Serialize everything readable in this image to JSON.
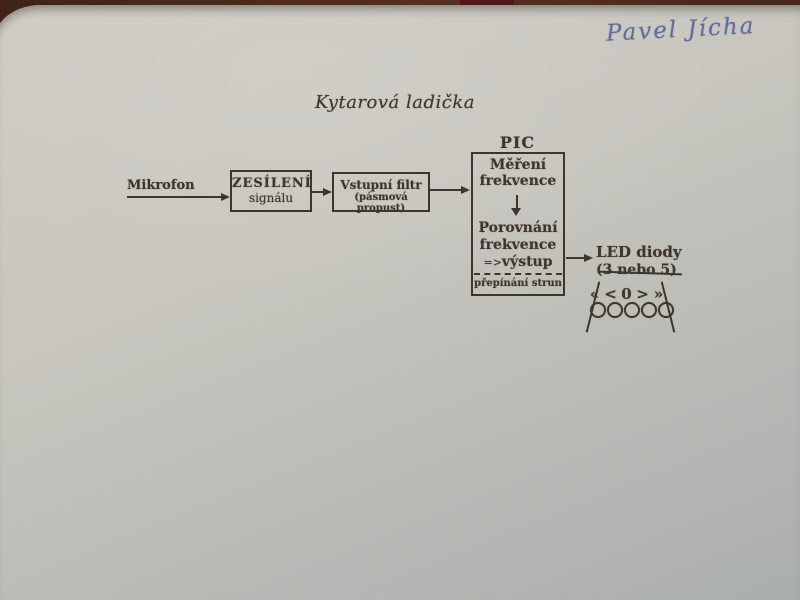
{
  "photo": {
    "table_color": "#4c2a1a",
    "paper_color_top": "#cecbc4",
    "paper_color_bottom": "#a9adae",
    "ink_color": "#3f352d",
    "handwriting_color": "#5f6d9c"
  },
  "handwriting": {
    "name": "Pavel Jícha"
  },
  "title": "Kytarová ladička",
  "diagram": {
    "mikrofon": "Mikrofon",
    "amp_box": {
      "line1": "ZESÍLENÍ",
      "line2": "signálu"
    },
    "filter_box": {
      "line1": "Vstupní filtr",
      "line2": "(pásmová propust)"
    },
    "pic": {
      "label": "PIC",
      "block1_line1": "Měření",
      "block1_line2": "frekvence",
      "block2_line1": "Porovnání",
      "block2_line2": "frekvence",
      "block2_line3_prefix": "=>",
      "block2_line3_text": "výstup",
      "footer": "přepínání strun"
    },
    "led": {
      "line1": "LED diody",
      "line2_open": "(3 ",
      "line2_struck": "nebo 5",
      "line2_close": ")",
      "symbols": [
        "«",
        "<",
        "0",
        ">",
        "»"
      ],
      "led_count": 5
    }
  }
}
